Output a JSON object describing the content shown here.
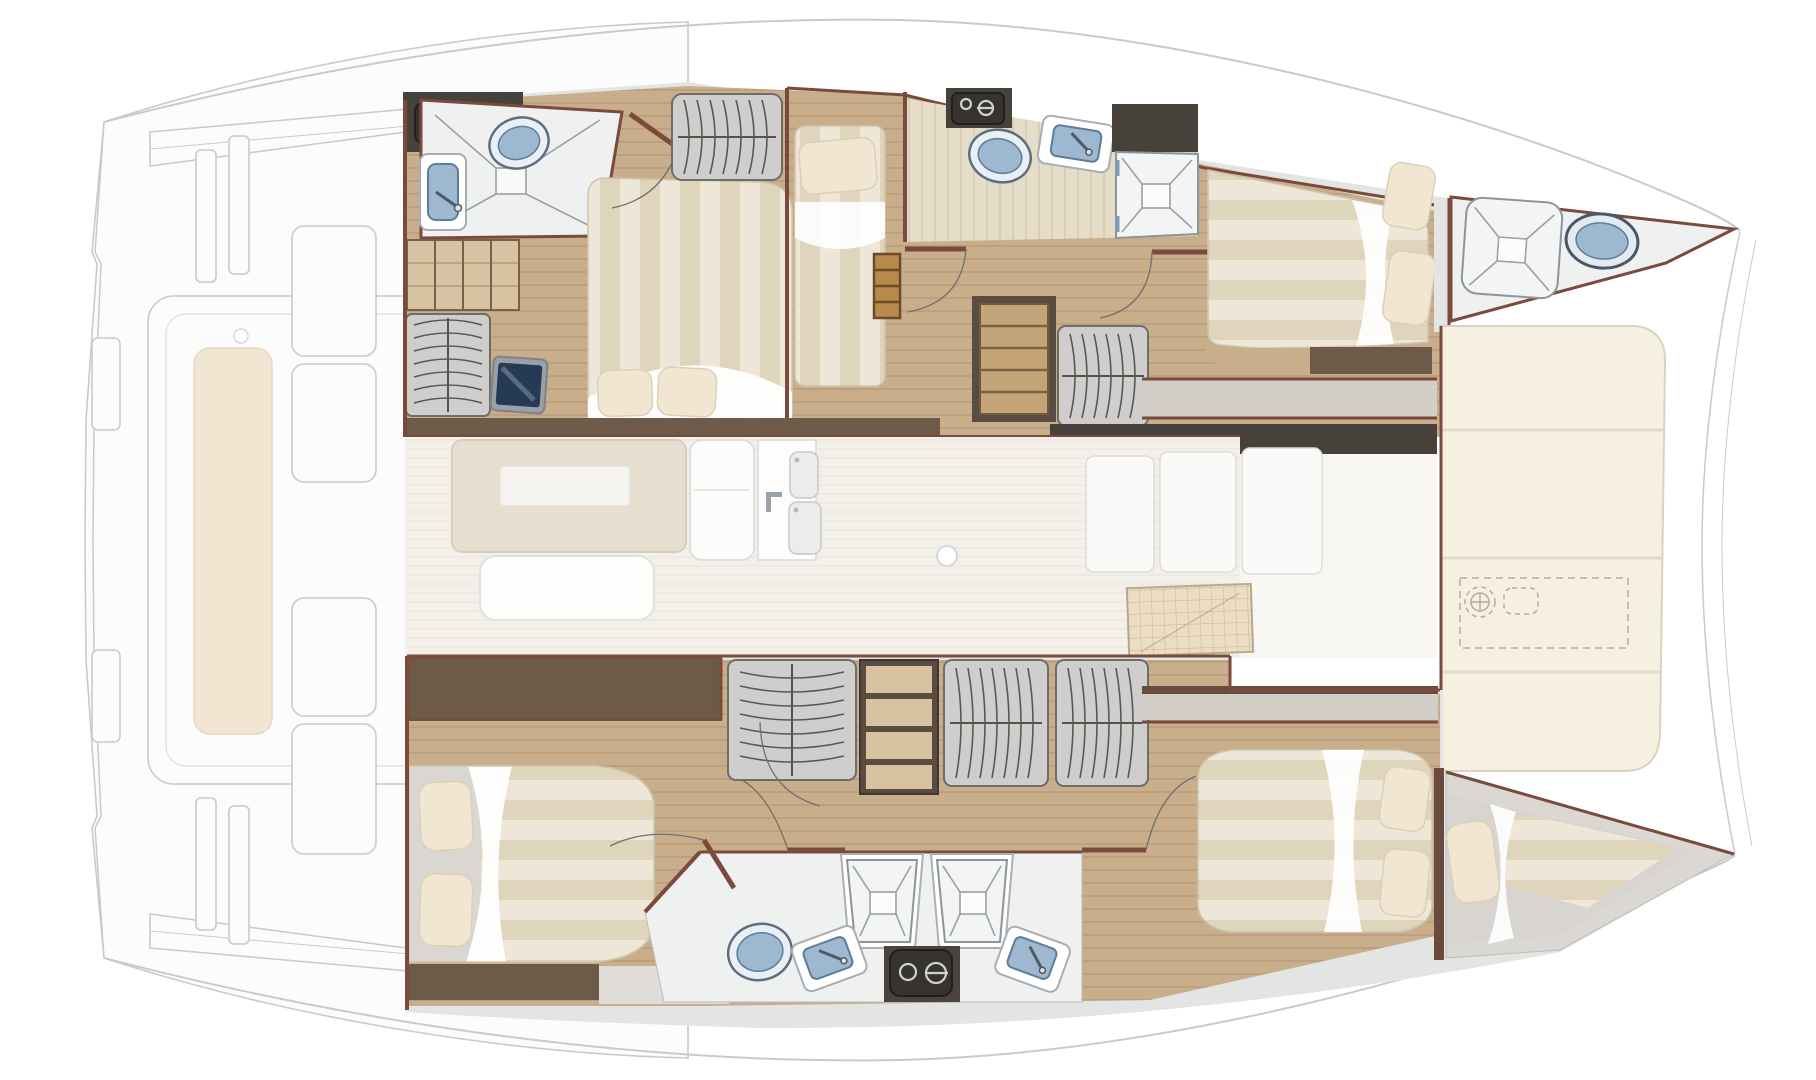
{
  "meta": {
    "title": "Catamaran yacht interior layout — top view floor plan",
    "type": "floorplan",
    "orientation": "bow to the right, stern (ghosted cockpit) to the left"
  },
  "colors": {
    "page_bg": "#ffffff",
    "ghost_stroke": "#c9cacd",
    "ghost_fill": "#fcfcfd",
    "wall": "#7a4a3c",
    "charcoal": "#46413b",
    "wood_dark": "#6e5a49",
    "wood_floor": "#c9ae8c",
    "gray_wood": "#d2cfc9",
    "marble": "#e3e4e4",
    "marble_light": "#eff1f1",
    "saloon_floor": "#f3f0ea",
    "cream": "#f6f0e1",
    "bed_base": "#eee7d7",
    "bed_stripe": "#cbbc9c",
    "pillow": "#f1e6d1",
    "fixture_blue": "#9db8cf",
    "fixture_blue_dark": "#5d7d9a",
    "appliance_dark": "#37342f",
    "steps_wood": "#c5a478",
    "ladder_wood": "#b9884c",
    "table_beige": "#e6decf",
    "hatch_tan": "#ecdcc2"
  },
  "areas": {
    "port_hull": [
      "owner-cabin-double-bed",
      "owner-bathroom",
      "guest-single-cabin",
      "mid-bathroom",
      "companionway-steps",
      "forward-double-cabin",
      "forepeak-head"
    ],
    "starboard_hull": [
      "aft-double-cabin",
      "wardrobes",
      "twin-showers",
      "twin-sinks",
      "washing-machine",
      "forward-double-cabin",
      "bow-berth"
    ],
    "bridge_deck": [
      "saloon-dinette",
      "saloon-bench",
      "entry-door-with-sinks",
      "galley-ghost",
      "foredeck-sunpads",
      "anchor-windlass"
    ],
    "ghosted": [
      "aft-cockpit",
      "bimini-band",
      "cockpit-posts",
      "cockpit-bench-cushion"
    ]
  },
  "fixture_glyphs": [
    "double-bed",
    "single-bed",
    "pillow",
    "toilet",
    "sink",
    "shower-tray",
    "wardrobe-hangers",
    "shelves",
    "washing-machine",
    "tv-screen",
    "ladder",
    "steps",
    "dinette-table",
    "bench",
    "knob",
    "grid-hatch",
    "windlass",
    "sunpad",
    "door-swing"
  ]
}
